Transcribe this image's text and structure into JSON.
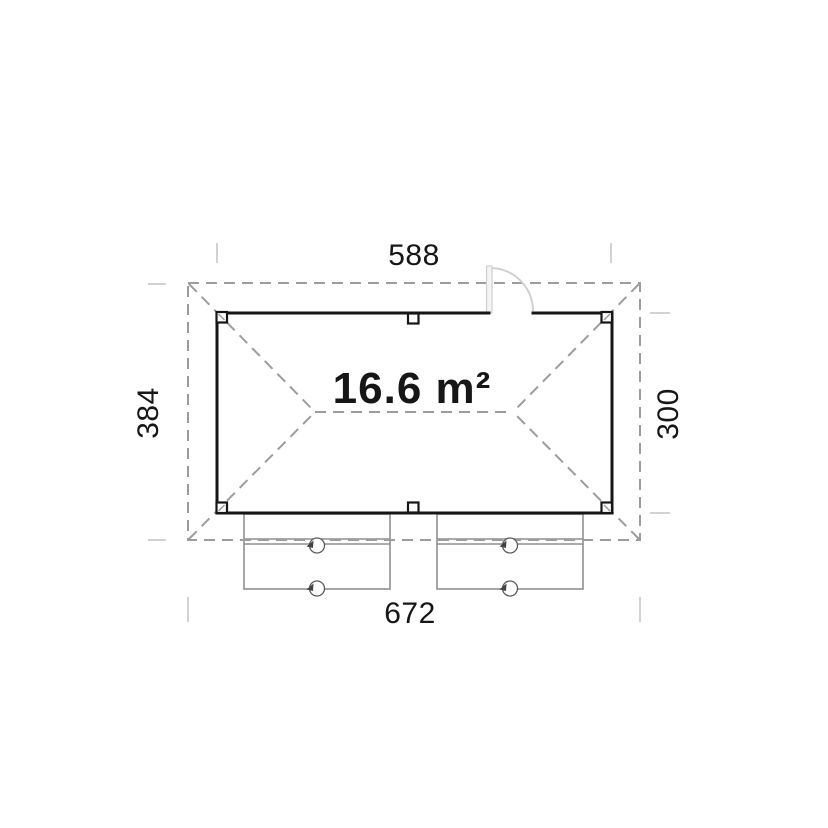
{
  "drawing": {
    "type": "floor-plan",
    "area_label": "16.6 m²",
    "dimensions": {
      "top": "588",
      "left": "384",
      "right": "300",
      "bottom": "672"
    },
    "colors": {
      "wall": "#161616",
      "roof_dash": "#9c9c9c",
      "extension_tick": "#d2d2d2",
      "door": "#cfcfcf",
      "bench": "#8f8f8f",
      "text": "#161616",
      "background": "#ffffff"
    }
  }
}
